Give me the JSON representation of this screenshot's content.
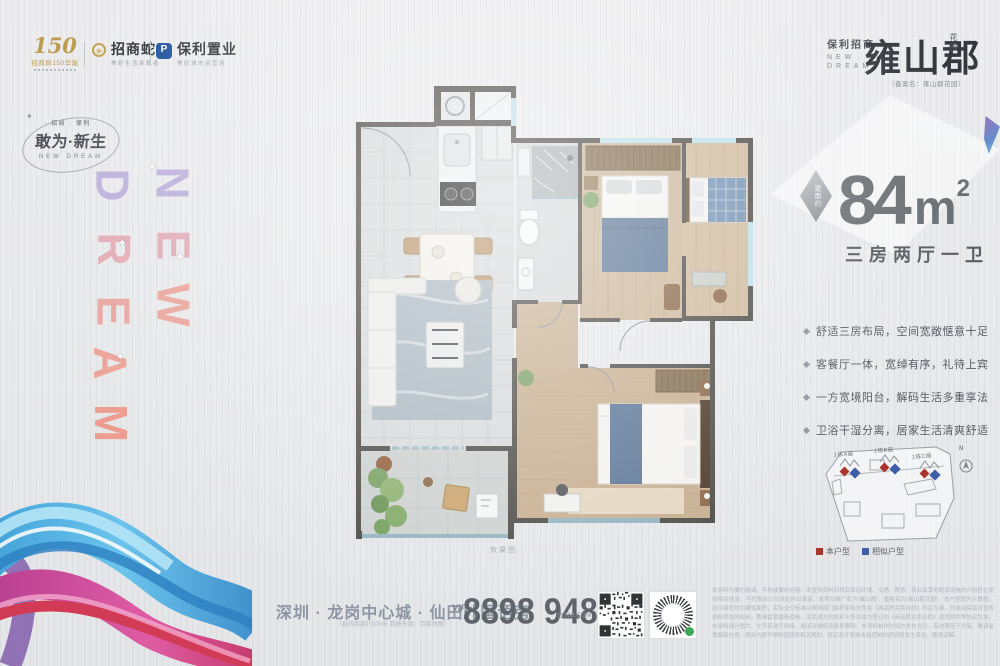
{
  "brand_bar": {
    "anniversary": {
      "number": "150",
      "title": "招商局150华诞"
    },
    "cmsk": {
      "name": "招商蛇口",
      "tagline": "美好生活承载者"
    },
    "poly": {
      "name": "保利置业",
      "tagline": "美好城市运营商",
      "monogram": "P"
    }
  },
  "emblem": {
    "top": "· 招商 · 保利 ·",
    "main": "敢为·新生",
    "bottom": "NEW DREAM",
    "star": "✦"
  },
  "vertical_letters": {
    "new": [
      "N",
      "E",
      "W"
    ],
    "dream": [
      "D",
      "R",
      "E",
      "A",
      "M"
    ],
    "colors_new": [
      "#b3a6d8",
      "#dfa2ae",
      "#eb9a8e"
    ],
    "colors_dream": [
      "#b6a9da",
      "#e2a3ad",
      "#e89c96",
      "#ee998b",
      "#ef9181"
    ]
  },
  "masthead": {
    "brand": "保利招商",
    "en_line1": "NEW",
    "en_line2": "DREAM",
    "project_name": "雍山郡",
    "project_suffix": "花园",
    "filing_note": "（备案名：雍山郡花园）"
  },
  "area_block": {
    "badge": "建面约",
    "value": "84",
    "unit": "m",
    "exp": "2",
    "layout": "三房两厅一卫"
  },
  "selling_points": [
    {
      "text": "舒适三房布局，空间宽敞惬意十足"
    },
    {
      "text": "客餐厅一体，宽绰有序，礼待上宾"
    },
    {
      "text": "一方宽境阳台，解码生活多重享法"
    },
    {
      "text": "卫浴干湿分离，居家生活清爽舒适"
    }
  ],
  "floorplan": {
    "caption": "效果图"
  },
  "siteplan": {
    "towers": [
      {
        "label": "1栋A座"
      },
      {
        "label": "1栋B座"
      },
      {
        "label": "1栋C座"
      }
    ],
    "compass": "N",
    "legend": [
      {
        "label": "本户型",
        "color": "#a9352c"
      },
      {
        "label": "相似户型",
        "color": "#3e5fa7"
      }
    ]
  },
  "footer": {
    "address": "深圳 · 龙岗中心城 · 仙田外国语旁",
    "address_note": "（直线距离约300米 数据来源：百度地图）",
    "vip_label": "VIP",
    "phone": "8898 9488",
    "phone_suffix": "@163.COM",
    "disclaimer": "本资料为要约邀请，不构成要约内容。本宣传资料对项目周边环境、交通、教育、商业及其他配套设施的介绍旨在提供相关信息，不代表本公司对此作出承诺。本项目推广名为“雍山郡”，备案名为“雍山郡花园”。本户型图为示意图，所示面积均为建筑面积，实际交付标准以政府部门最终审批文件及《商品房买卖合同》约定为准。开发商保留对宣传资料修改的权利，敬请留意最新资料。买卖双方的权利义务以双方签订的《商品房买卖合同》及其附件等协议为准。本资料部分图片、文字来源于网络，如涉及侵权请联系删除。本资料制作时间为发布当月，有效期至下月底，敬请留意最新信息。相关内容不排除因政府相关规划、规定及开发商未能控制的原因而发生变化，敬请谅解。"
  }
}
